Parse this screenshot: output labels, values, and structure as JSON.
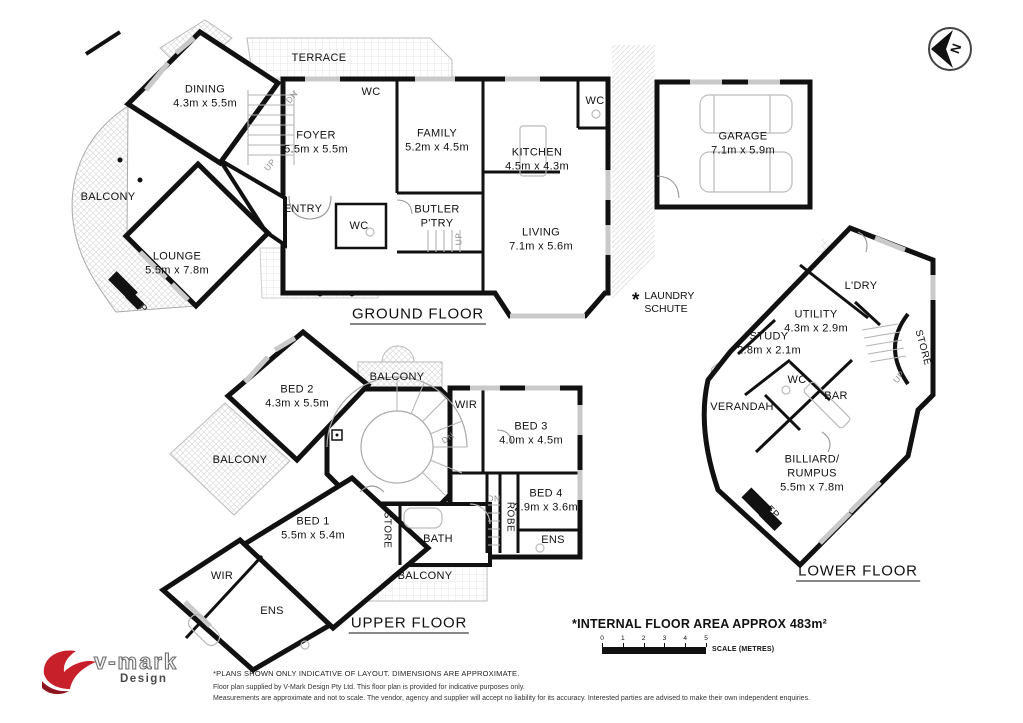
{
  "colors": {
    "wall": "#111111",
    "hatch": "#d9d9d9",
    "window": "#c9c9c9",
    "logo_red": "#c8202a",
    "text": "#111111"
  },
  "compass": {
    "letter": "N"
  },
  "floor_titles": [
    {
      "id": "ground-floor",
      "text": "GROUND FLOOR",
      "x": 418,
      "y": 315
    },
    {
      "id": "upper-floor",
      "text": "UPPER FLOOR",
      "x": 409,
      "y": 624
    },
    {
      "id": "lower-floor",
      "text": "LOWER FLOOR",
      "x": 858,
      "y": 572
    }
  ],
  "rooms": [
    {
      "floor": "ground",
      "id": "terrace",
      "lines": [
        "TERRACE"
      ],
      "x": 319,
      "y": 59
    },
    {
      "floor": "ground",
      "id": "dining",
      "lines": [
        "DINING",
        "4.3m x 5.5m"
      ],
      "x": 205,
      "y": 97
    },
    {
      "floor": "ground",
      "id": "balcony-ground",
      "lines": [
        "BALCONY"
      ],
      "x": 108,
      "y": 198
    },
    {
      "floor": "ground",
      "id": "lounge",
      "lines": [
        "LOUNGE",
        "5.5m x 7.8m"
      ],
      "x": 177,
      "y": 264
    },
    {
      "floor": "ground",
      "id": "foyer",
      "lines": [
        "FOYER",
        "5.5m x 5.5m"
      ],
      "x": 316,
      "y": 143
    },
    {
      "floor": "ground",
      "id": "wc-foyer",
      "lines": [
        "WC"
      ],
      "x": 371,
      "y": 93
    },
    {
      "floor": "ground",
      "id": "family",
      "lines": [
        "FAMILY",
        "5.2m x 4.5m"
      ],
      "x": 437,
      "y": 141
    },
    {
      "floor": "ground",
      "id": "kitchen",
      "lines": [
        "KITCHEN",
        "4.5m x 4.3m"
      ],
      "x": 537,
      "y": 160
    },
    {
      "floor": "ground",
      "id": "wc-kitchen",
      "lines": [
        "WC"
      ],
      "x": 595,
      "y": 102
    },
    {
      "floor": "ground",
      "id": "entry",
      "lines": [
        "ENTRY"
      ],
      "x": 303,
      "y": 210
    },
    {
      "floor": "ground",
      "id": "wc-entry",
      "lines": [
        "WC"
      ],
      "x": 359,
      "y": 227
    },
    {
      "floor": "ground",
      "id": "butler-pantry",
      "lines": [
        "BUTLER",
        "P'TRY"
      ],
      "x": 437,
      "y": 217
    },
    {
      "floor": "ground",
      "id": "living",
      "lines": [
        "LIVING",
        "7.1m x 5.6m"
      ],
      "x": 541,
      "y": 240
    },
    {
      "floor": "ground",
      "id": "garage",
      "lines": [
        "GARAGE",
        "7.1m x 5.9m"
      ],
      "x": 743,
      "y": 144
    },
    {
      "floor": "ground",
      "id": "fp-lounge",
      "lines": [
        "FP"
      ],
      "x": 140,
      "y": 307,
      "rot": 45,
      "cls": "tiny"
    },
    {
      "floor": "ground",
      "id": "up-foyer",
      "lines": [
        "UP"
      ],
      "x": 270,
      "y": 165,
      "rot": -50,
      "cls": "stair"
    },
    {
      "floor": "ground",
      "id": "dn-foyer",
      "lines": [
        "DN"
      ],
      "x": 292,
      "y": 97,
      "rot": -50,
      "cls": "stair"
    },
    {
      "floor": "ground",
      "id": "up-butler",
      "lines": [
        "UP"
      ],
      "x": 459,
      "y": 239,
      "rot": -90,
      "cls": "stair"
    },
    {
      "floor": "upper",
      "id": "bed2",
      "lines": [
        "BED 2",
        "4.3m x 5.5m"
      ],
      "x": 297,
      "y": 397
    },
    {
      "floor": "upper",
      "id": "balcony-upper-top",
      "lines": [
        "BALCONY"
      ],
      "x": 397,
      "y": 378
    },
    {
      "floor": "upper",
      "id": "balcony-upper-left",
      "lines": [
        "BALCONY"
      ],
      "x": 240,
      "y": 461
    },
    {
      "floor": "upper",
      "id": "wir-upper-right",
      "lines": [
        "WIR"
      ],
      "x": 466,
      "y": 406
    },
    {
      "floor": "upper",
      "id": "bed3",
      "lines": [
        "BED 3",
        "4.0m x 4.5m"
      ],
      "x": 531,
      "y": 434
    },
    {
      "floor": "upper",
      "id": "bed4",
      "lines": [
        "BED 4",
        "2.9m x 3.6m"
      ],
      "x": 546,
      "y": 501
    },
    {
      "floor": "upper",
      "id": "robe",
      "lines": [
        "ROBE"
      ],
      "x": 509,
      "y": 517,
      "rot": 90,
      "cls": "tiny"
    },
    {
      "floor": "upper",
      "id": "bed1",
      "lines": [
        "BED 1",
        "5.5m x 5.4m"
      ],
      "x": 313,
      "y": 529
    },
    {
      "floor": "upper",
      "id": "store-upper",
      "lines": [
        "STORE"
      ],
      "x": 386,
      "y": 530,
      "rot": 90,
      "cls": "tiny"
    },
    {
      "floor": "upper",
      "id": "bath",
      "lines": [
        "BATH"
      ],
      "x": 438,
      "y": 540
    },
    {
      "floor": "upper",
      "id": "ens-upper-right",
      "lines": [
        "ENS"
      ],
      "x": 553,
      "y": 541
    },
    {
      "floor": "upper",
      "id": "wir-upper-left",
      "lines": [
        "WIR"
      ],
      "x": 222,
      "y": 577
    },
    {
      "floor": "upper",
      "id": "ens-upper-left",
      "lines": [
        "ENS"
      ],
      "x": 272,
      "y": 612
    },
    {
      "floor": "upper",
      "id": "balcony-upper-bottom",
      "lines": [
        "BALCONY"
      ],
      "x": 425,
      "y": 577
    },
    {
      "floor": "upper",
      "id": "dn-spiral",
      "lines": [
        "DN"
      ],
      "x": 448,
      "y": 438,
      "rot": -35,
      "cls": "stair"
    },
    {
      "floor": "upper",
      "id": "dn-back",
      "lines": [
        "DN"
      ],
      "x": 494,
      "y": 499,
      "cls": "stair"
    },
    {
      "floor": "lower",
      "id": "ldry",
      "lines": [
        "L'DRY"
      ],
      "x": 861,
      "y": 287
    },
    {
      "floor": "lower",
      "id": "utility",
      "lines": [
        "UTILITY",
        "4.3m x 2.9m"
      ],
      "x": 816,
      "y": 322
    },
    {
      "floor": "lower",
      "id": "study",
      "lines": [
        "STUDY",
        "2.8m x 2.1m"
      ],
      "x": 769,
      "y": 344
    },
    {
      "floor": "lower",
      "id": "wc-lower",
      "lines": [
        "WC"
      ],
      "x": 797,
      "y": 381
    },
    {
      "floor": "lower",
      "id": "bar",
      "lines": [
        "BAR"
      ],
      "x": 836,
      "y": 397
    },
    {
      "floor": "lower",
      "id": "store-lower",
      "lines": [
        "STORE"
      ],
      "x": 922,
      "y": 348,
      "rot": 75,
      "cls": "tiny"
    },
    {
      "floor": "lower",
      "id": "verandah",
      "lines": [
        "VERANDAH"
      ],
      "x": 742,
      "y": 408
    },
    {
      "floor": "lower",
      "id": "billiard-rumpus",
      "lines": [
        "BILLIARD/",
        "RUMPUS",
        "5.5m x 7.8m"
      ],
      "x": 812,
      "y": 474
    },
    {
      "floor": "lower",
      "id": "fp-billiard",
      "lines": [
        "FP"
      ],
      "x": 772,
      "y": 513,
      "rot": 45,
      "cls": "tiny"
    },
    {
      "floor": "lower",
      "id": "up-lower",
      "lines": [
        "UP"
      ],
      "x": 899,
      "y": 377,
      "rot": -50,
      "cls": "stair"
    }
  ],
  "annotations": {
    "laundry_note": {
      "star": "*",
      "lines": [
        "LAUNDRY",
        "SCHUTE"
      ]
    },
    "internal_area": "*INTERNAL FLOOR AREA APPROX 483m²"
  },
  "scale": {
    "ticks": [
      "0",
      "1",
      "2",
      "3",
      "4",
      "5"
    ],
    "label": "SCALE (METRES)"
  },
  "footer": {
    "lines": [
      "*PLANS SHOWN ONLY INDICATIVE OF LAYOUT. DIMENSIONS ARE APPROXIMATE.",
      "Floor plan supplied by V-Mark Design Pty Ltd. This floor plan is provided for indicative purposes only.",
      "Measurements are approximate and not to scale. The vendor, agency and supplier will accept no liability for its accuracy. Interested parties are advised to make their own independent enquiries."
    ]
  },
  "logo": {
    "brand": "v-mark",
    "sub": "Design"
  }
}
